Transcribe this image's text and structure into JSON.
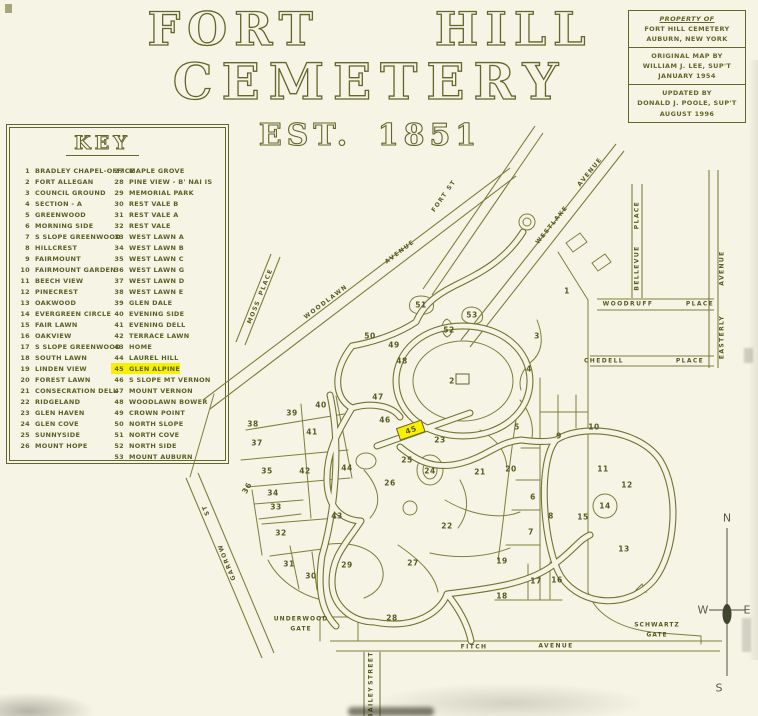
{
  "colors": {
    "ink": "#63662a",
    "paper": "#f6f4e4",
    "highlight": "#f9f000"
  },
  "title": {
    "line1": "FORT HILL",
    "line2": "CEMETERY",
    "line3": "EST. 1851"
  },
  "property_box": {
    "l1": "PROPERTY OF",
    "l2": "FORT HILL CEMETERY",
    "l3": "AUBURN, NEW YORK",
    "l4": "ORIGINAL MAP BY",
    "l5": "WILLIAM J. LEE, SUP'T",
    "l6": "JANUARY 1954",
    "l7": "UPDATED BY",
    "l8": "DONALD J. POOLE, SUP'T",
    "l9": "AUGUST 1996"
  },
  "key": {
    "title": "KEY",
    "col1": [
      {
        "n": "1",
        "label": "BRADLEY CHAPEL-OFFICE"
      },
      {
        "n": "2",
        "label": "FORT ALLEGAN"
      },
      {
        "n": "3",
        "label": "COUNCIL GROUND"
      },
      {
        "n": "4",
        "label": "SECTION - A"
      },
      {
        "n": "5",
        "label": "GREENWOOD"
      },
      {
        "n": "6",
        "label": "MORNING SIDE"
      },
      {
        "n": "7",
        "label": "S SLOPE GREENWOOD"
      },
      {
        "n": "8",
        "label": "HILLCREST"
      },
      {
        "n": "9",
        "label": "FAIRMOUNT"
      },
      {
        "n": "10",
        "label": "FAIRMOUNT GARDEN"
      },
      {
        "n": "11",
        "label": "BEECH VIEW"
      },
      {
        "n": "12",
        "label": "PINECREST"
      },
      {
        "n": "13",
        "label": "OAKWOOD"
      },
      {
        "n": "14",
        "label": "EVERGREEN CIRCLE"
      },
      {
        "n": "15",
        "label": "FAIR LAWN"
      },
      {
        "n": "16",
        "label": "OAKVIEW"
      },
      {
        "n": "17",
        "label": "S SLOPE GREENWOOD"
      },
      {
        "n": "18",
        "label": "SOUTH LAWN"
      },
      {
        "n": "19",
        "label": "LINDEN VIEW"
      },
      {
        "n": "20",
        "label": "FOREST LAWN"
      },
      {
        "n": "21",
        "label": "CONSECRATION DELL"
      },
      {
        "n": "22",
        "label": "RIDGELAND"
      },
      {
        "n": "23",
        "label": "GLEN HAVEN"
      },
      {
        "n": "24",
        "label": "GLEN COVE"
      },
      {
        "n": "25",
        "label": "SUNNYSIDE"
      },
      {
        "n": "26",
        "label": "MOUNT HOPE"
      }
    ],
    "col2": [
      {
        "n": "27",
        "label": "MAPLE GROVE"
      },
      {
        "n": "28",
        "label": "PINE VIEW - B' NAI IS"
      },
      {
        "n": "29",
        "label": "MEMORIAL PARK"
      },
      {
        "n": "30",
        "label": "REST VALE B"
      },
      {
        "n": "31",
        "label": "REST VALE A"
      },
      {
        "n": "32",
        "label": "REST VALE"
      },
      {
        "n": "33",
        "label": "WEST LAWN A"
      },
      {
        "n": "34",
        "label": "WEST LAWN B"
      },
      {
        "n": "35",
        "label": "WEST LAWN C"
      },
      {
        "n": "36",
        "label": "WEST LAWN G"
      },
      {
        "n": "37",
        "label": "WEST LAWN D"
      },
      {
        "n": "38",
        "label": "WEST LAWN E"
      },
      {
        "n": "39",
        "label": "GLEN DALE"
      },
      {
        "n": "40",
        "label": "EVENING SIDE"
      },
      {
        "n": "41",
        "label": "EVENING DELL"
      },
      {
        "n": "42",
        "label": "TERRACE LAWN"
      },
      {
        "n": "43",
        "label": "HOME"
      },
      {
        "n": "44",
        "label": "LAUREL HILL"
      },
      {
        "n": "45",
        "label": "GLEN ALPINE",
        "hl": true
      },
      {
        "n": "46",
        "label": "S SLOPE MT VERNON"
      },
      {
        "n": "47",
        "label": "MOUNT VERNON"
      },
      {
        "n": "48",
        "label": "WOODLAWN BOWER"
      },
      {
        "n": "49",
        "label": "CROWN POINT"
      },
      {
        "n": "50",
        "label": "NORTH SLOPE"
      },
      {
        "n": "51",
        "label": "NORTH COVE"
      },
      {
        "n": "52",
        "label": "NORTH SIDE"
      },
      {
        "n": "53",
        "label": "MOUNT AUBURN"
      }
    ]
  },
  "map": {
    "sections": [
      {
        "n": "1",
        "x": 567,
        "y": 291
      },
      {
        "n": "2",
        "x": 452,
        "y": 381
      },
      {
        "n": "3",
        "x": 537,
        "y": 336
      },
      {
        "n": "4",
        "x": 529,
        "y": 369
      },
      {
        "n": "5",
        "x": 517,
        "y": 427
      },
      {
        "n": "6",
        "x": 533,
        "y": 497
      },
      {
        "n": "7",
        "x": 531,
        "y": 532
      },
      {
        "n": "8",
        "x": 551,
        "y": 516
      },
      {
        "n": "9",
        "x": 559,
        "y": 436
      },
      {
        "n": "10",
        "x": 594,
        "y": 427
      },
      {
        "n": "11",
        "x": 603,
        "y": 469
      },
      {
        "n": "12",
        "x": 627,
        "y": 485
      },
      {
        "n": "13",
        "x": 624,
        "y": 549
      },
      {
        "n": "14",
        "x": 605,
        "y": 506
      },
      {
        "n": "15",
        "x": 583,
        "y": 517
      },
      {
        "n": "16",
        "x": 557,
        "y": 580
      },
      {
        "n": "17",
        "x": 536,
        "y": 581
      },
      {
        "n": "18",
        "x": 502,
        "y": 596
      },
      {
        "n": "19",
        "x": 502,
        "y": 561
      },
      {
        "n": "20",
        "x": 511,
        "y": 469
      },
      {
        "n": "21",
        "x": 480,
        "y": 472
      },
      {
        "n": "22",
        "x": 447,
        "y": 526
      },
      {
        "n": "23",
        "x": 440,
        "y": 440
      },
      {
        "n": "24",
        "x": 430,
        "y": 471
      },
      {
        "n": "25",
        "x": 407,
        "y": 460
      },
      {
        "n": "26",
        "x": 390,
        "y": 483
      },
      {
        "n": "27",
        "x": 413,
        "y": 563
      },
      {
        "n": "28",
        "x": 392,
        "y": 618
      },
      {
        "n": "29",
        "x": 347,
        "y": 565
      },
      {
        "n": "30",
        "x": 311,
        "y": 576
      },
      {
        "n": "31",
        "x": 289,
        "y": 564
      },
      {
        "n": "32",
        "x": 281,
        "y": 533
      },
      {
        "n": "33",
        "x": 276,
        "y": 507
      },
      {
        "n": "34",
        "x": 273,
        "y": 493
      },
      {
        "n": "35",
        "x": 267,
        "y": 471
      },
      {
        "n": "36",
        "x": 247,
        "y": 488,
        "rot": -60
      },
      {
        "n": "37",
        "x": 257,
        "y": 443
      },
      {
        "n": "38",
        "x": 253,
        "y": 424
      },
      {
        "n": "39",
        "x": 292,
        "y": 413
      },
      {
        "n": "40",
        "x": 321,
        "y": 405
      },
      {
        "n": "41",
        "x": 312,
        "y": 432
      },
      {
        "n": "42",
        "x": 305,
        "y": 471
      },
      {
        "n": "43",
        "x": 337,
        "y": 516
      },
      {
        "n": "44",
        "x": 347,
        "y": 468
      },
      {
        "n": "45",
        "x": 411,
        "y": 430,
        "rot": -19,
        "box": true
      },
      {
        "n": "46",
        "x": 385,
        "y": 420
      },
      {
        "n": "47",
        "x": 378,
        "y": 397
      },
      {
        "n": "48",
        "x": 402,
        "y": 361
      },
      {
        "n": "49",
        "x": 394,
        "y": 345
      },
      {
        "n": "50",
        "x": 370,
        "y": 336
      },
      {
        "n": "51",
        "x": 421,
        "y": 305
      },
      {
        "n": "52",
        "x": 449,
        "y": 330
      },
      {
        "n": "53",
        "x": 472,
        "y": 315
      }
    ],
    "streets": [
      {
        "text": "WOODLAWN",
        "x": 326,
        "y": 302,
        "rot": -37
      },
      {
        "text": "AVENUE",
        "x": 400,
        "y": 252,
        "rot": -37
      },
      {
        "text": "MOSS",
        "x": 254,
        "y": 312,
        "rot": -68
      },
      {
        "text": "PLACE",
        "x": 266,
        "y": 282,
        "rot": -68
      },
      {
        "text": "FORT ST",
        "x": 444,
        "y": 196,
        "rot": -55
      },
      {
        "text": "WESTLAKE",
        "x": 552,
        "y": 225,
        "rot": -51
      },
      {
        "text": "AVENUE",
        "x": 590,
        "y": 172,
        "rot": -51
      },
      {
        "text": "BELLEVUE",
        "x": 637,
        "y": 268,
        "rot": -90
      },
      {
        "text": "PLACE",
        "x": 637,
        "y": 215,
        "rot": -90
      },
      {
        "text": "WOODRUFF",
        "x": 628,
        "y": 304,
        "rot": 0
      },
      {
        "text": "PLACE",
        "x": 700,
        "y": 304,
        "rot": 0
      },
      {
        "text": "CHEDELL",
        "x": 604,
        "y": 361,
        "rot": 0
      },
      {
        "text": "PLACE",
        "x": 690,
        "y": 361,
        "rot": 0
      },
      {
        "text": "EASTERLY",
        "x": 722,
        "y": 337,
        "rot": -90
      },
      {
        "text": "AVENUE",
        "x": 722,
        "y": 268,
        "rot": -90
      },
      {
        "text": "FITCH",
        "x": 474,
        "y": 647,
        "rot": 0
      },
      {
        "text": "AVENUE",
        "x": 556,
        "y": 646,
        "rot": 0
      },
      {
        "text": "BAILEY",
        "x": 371,
        "y": 702,
        "rot": -90
      },
      {
        "text": "STREET",
        "x": 371,
        "y": 668,
        "rot": -90
      },
      {
        "text": "GARROW",
        "x": 227,
        "y": 562,
        "rot": -112
      },
      {
        "text": "ST",
        "x": 206,
        "y": 510,
        "rot": -112
      }
    ],
    "gates": [
      {
        "line1": "UNDERWOOD",
        "line2": "GATE",
        "x": 301,
        "y": 624
      },
      {
        "line1": "SCHWARTZ",
        "line2": "GATE",
        "x": 657,
        "y": 630
      }
    ],
    "compass": [
      {
        "t": "N",
        "x": 727,
        "y": 518
      },
      {
        "t": "W",
        "x": 703,
        "y": 610
      },
      {
        "t": "E",
        "x": 747,
        "y": 610
      },
      {
        "t": "S",
        "x": 719,
        "y": 688
      }
    ]
  }
}
